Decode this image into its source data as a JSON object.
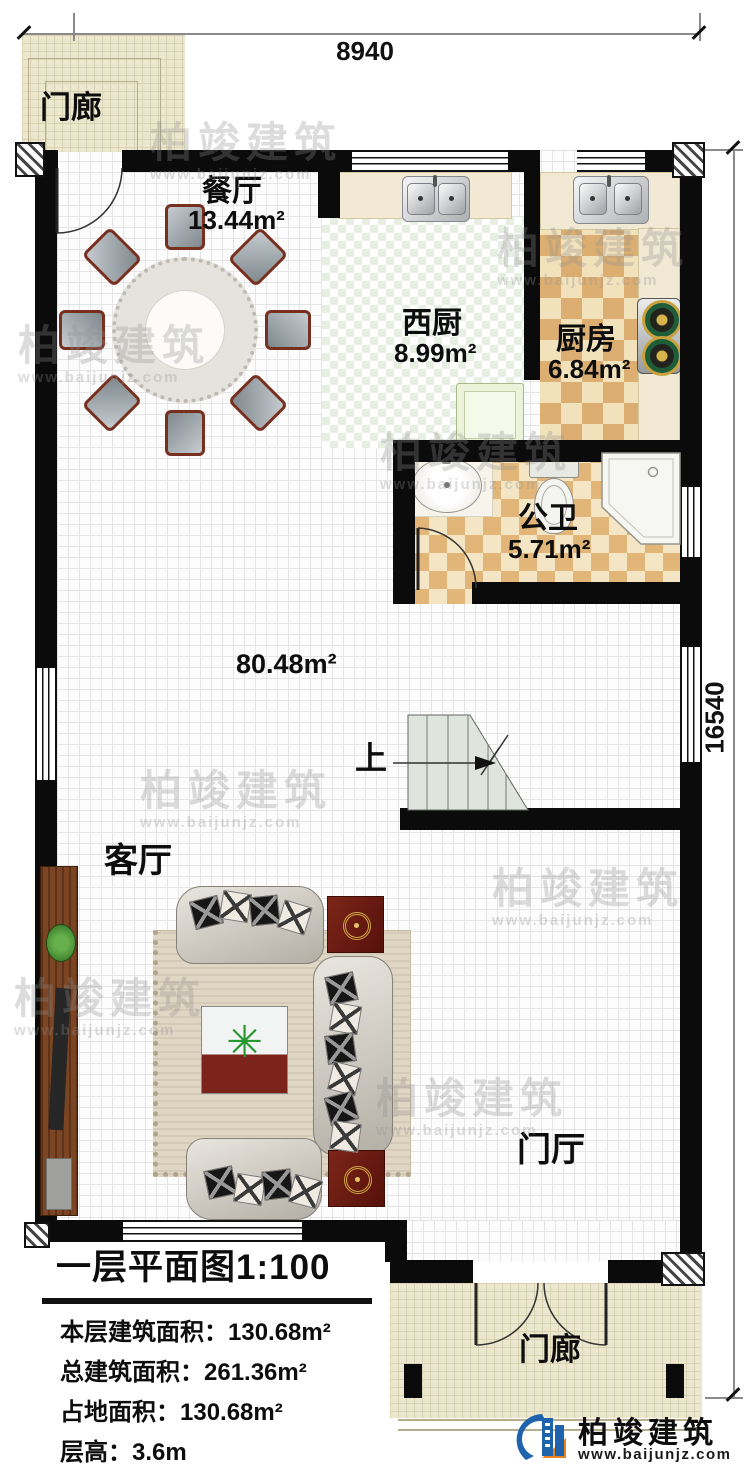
{
  "dimensions": {
    "width": "8940",
    "height": "16540"
  },
  "rooms": {
    "porch_top": {
      "name": "门廊"
    },
    "dining": {
      "name": "餐厅",
      "area": "13.44m²"
    },
    "west_kitchen": {
      "name": "西厨",
      "area": "8.99m²"
    },
    "kitchen": {
      "name": "厨房",
      "area": "6.84m²"
    },
    "bathroom": {
      "name": "公卫",
      "area": "5.71m²"
    },
    "open_area": {
      "area": "80.48m²"
    },
    "living": {
      "name": "客厅"
    },
    "foyer": {
      "name": "门厅"
    },
    "porch_bottom": {
      "name": "门廊"
    }
  },
  "stairs": {
    "direction_label": "上"
  },
  "title_block": {
    "title": "一层平面图1:100",
    "floor_area_line": "本层建筑面积：130.68m²",
    "total_area_line": "总建筑面积：261.36m²",
    "footprint_line": "占地面积：130.68m²",
    "floor_height_line": "层高：3.6m"
  },
  "logo": {
    "company": "柏竣建筑",
    "website": "www.baijunjz.com"
  },
  "watermark": {
    "company": "柏竣建筑",
    "website": "www.baijunjz.com"
  },
  "colors": {
    "wall": "#0b0b0b",
    "porch_floor": "#ece7cf",
    "kitchen_tile_dark": "#dcae72",
    "kitchen_tile_light": "#f2e2bc",
    "logo_blue": "#1f63ad",
    "logo_orange": "#e8821e"
  }
}
